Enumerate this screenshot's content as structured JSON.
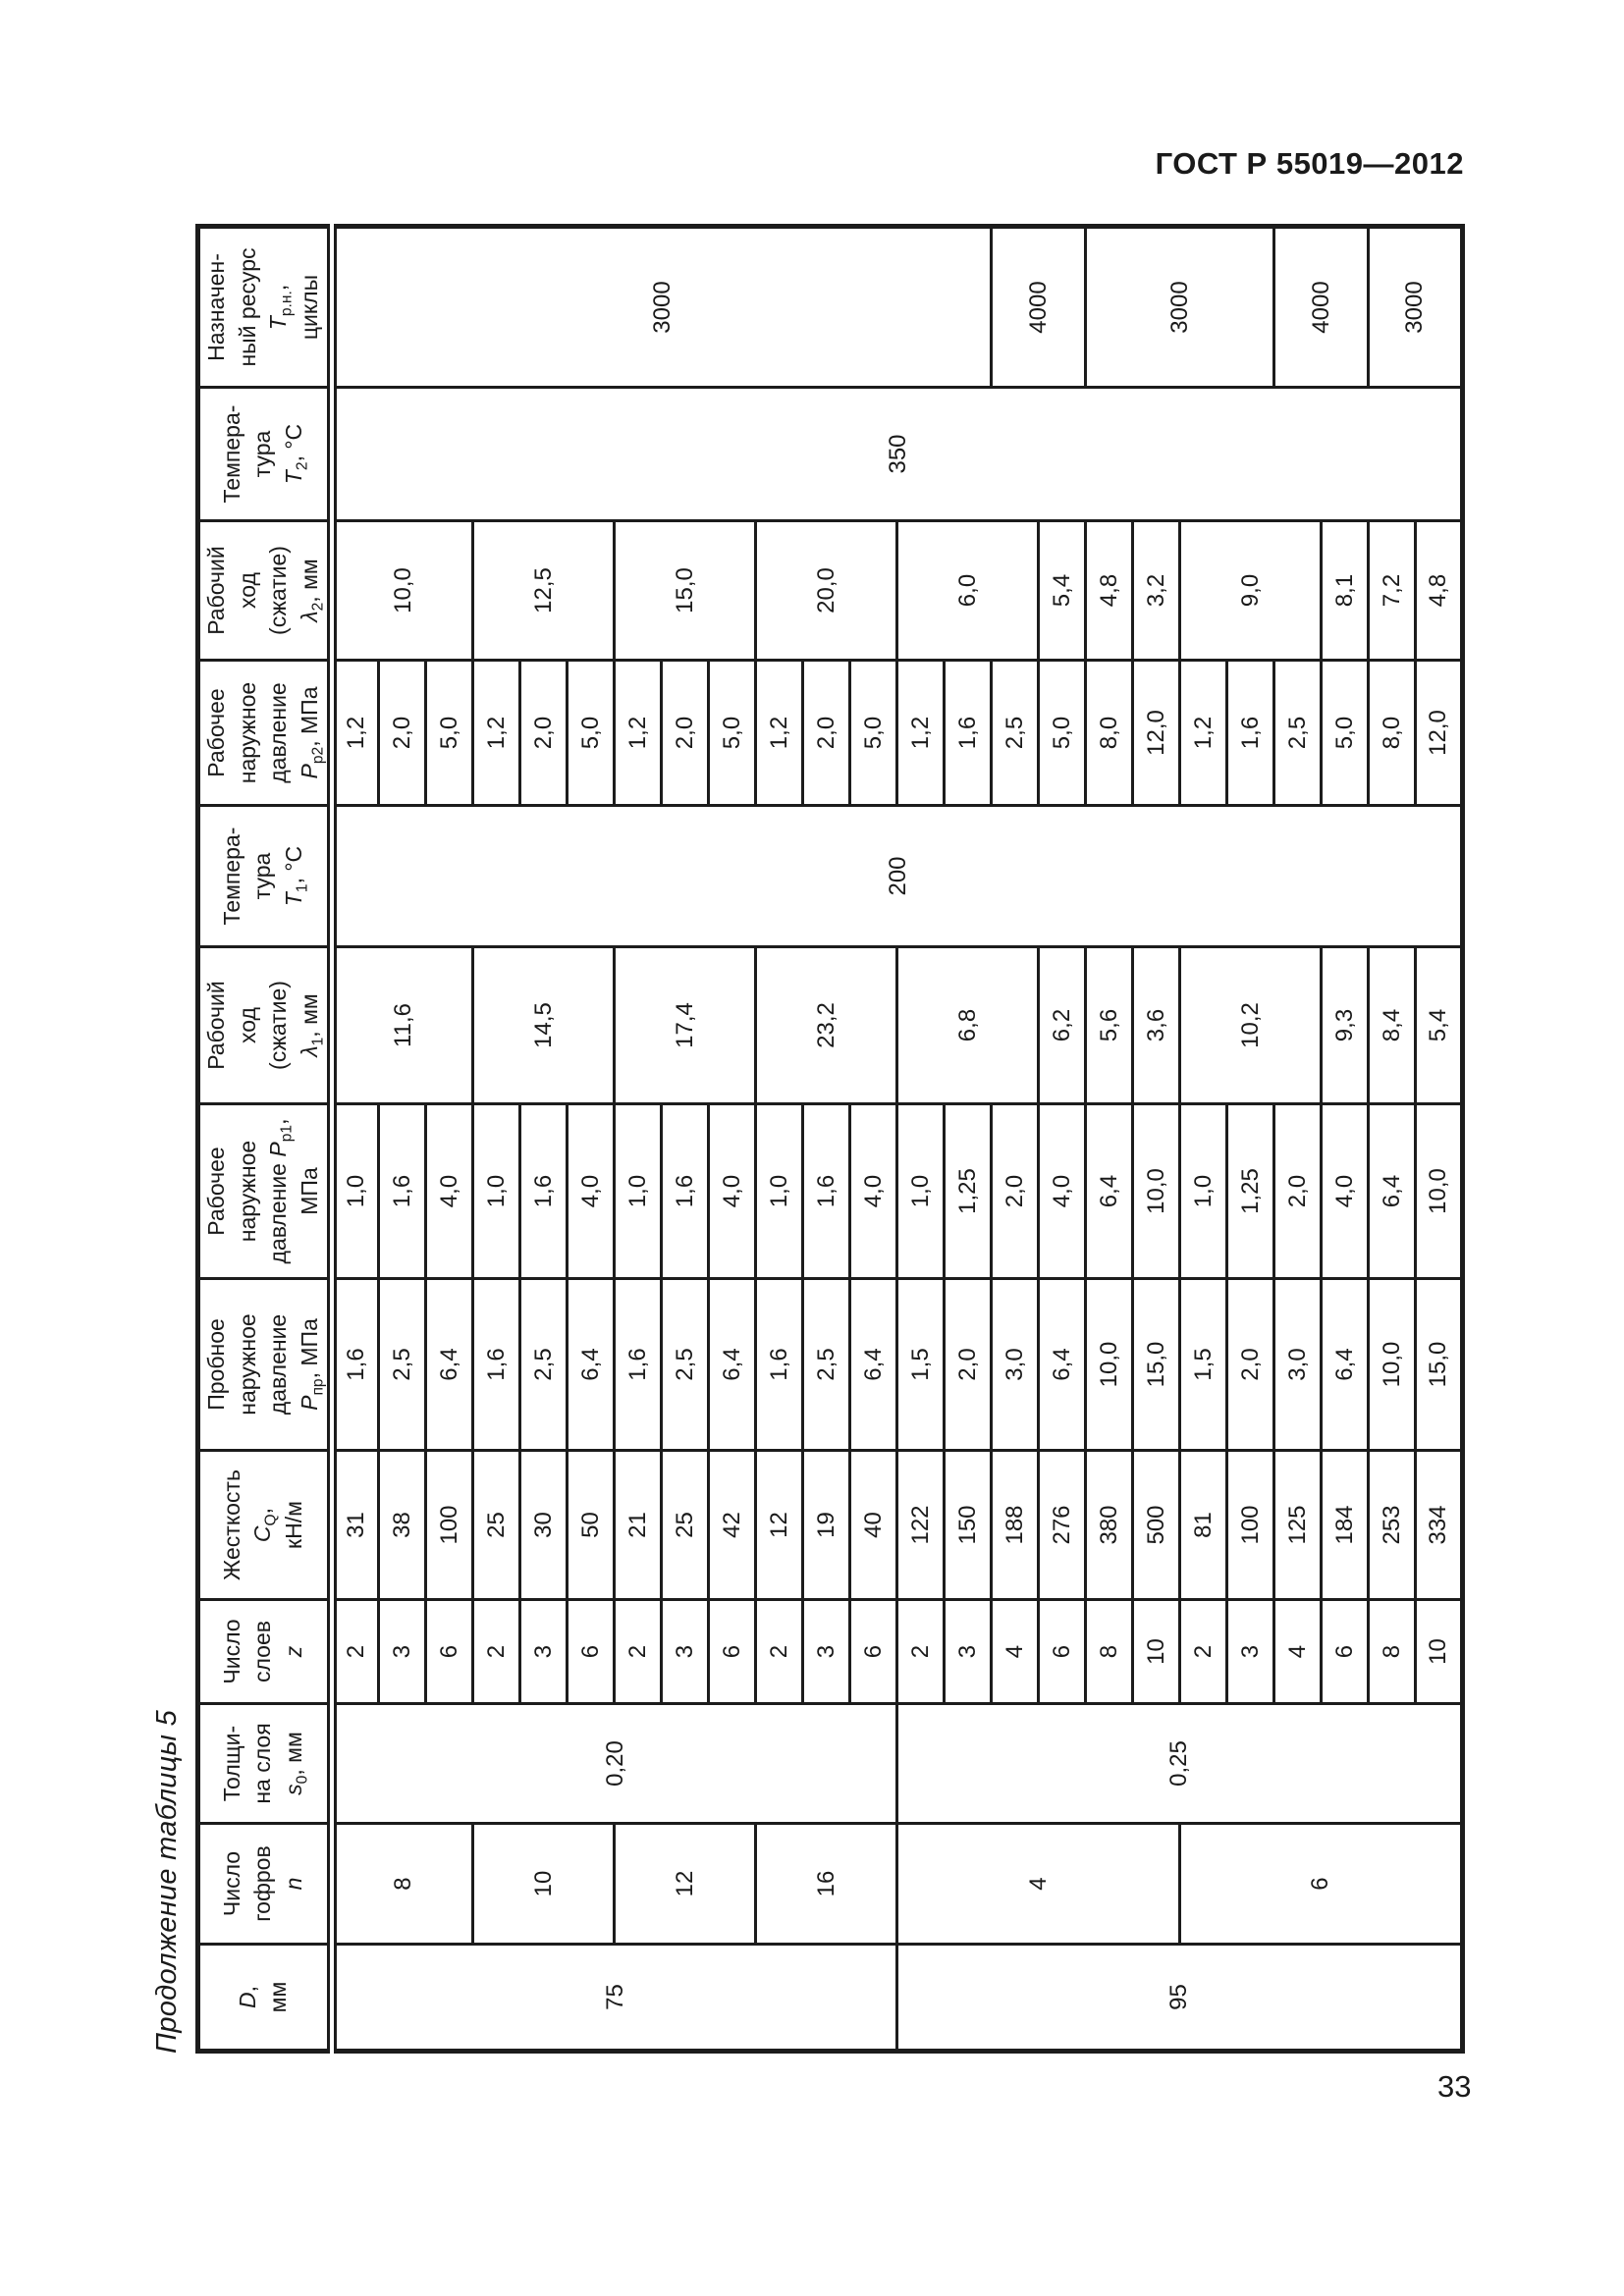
{
  "page": {
    "header_right": "ГОСТ Р 55019—2012",
    "caption": "Продолжение таблицы 5",
    "page_number": "33"
  },
  "table": {
    "row_count": 24,
    "columns": [
      {
        "key": "d",
        "width": 109,
        "label": [
          "*D*,",
          "мм"
        ],
        "cells": [
          {
            "t": "75",
            "s": 12
          },
          {
            "t": "95",
            "s": 12
          }
        ]
      },
      {
        "key": "n",
        "width": 123,
        "label": [
          "Число",
          "гофров",
          "*n*"
        ],
        "cells": [
          {
            "t": "8",
            "s": 3
          },
          {
            "t": "10",
            "s": 3
          },
          {
            "t": "12",
            "s": 3
          },
          {
            "t": "16",
            "s": 3
          },
          {
            "t": "4",
            "s": 6
          },
          {
            "t": "6",
            "s": 6
          }
        ]
      },
      {
        "key": "s0",
        "width": 122,
        "label": [
          "Толщи-",
          "на слоя",
          "*s*~0~, мм"
        ],
        "cells": [
          {
            "t": "0,20",
            "s": 12
          },
          {
            "t": "0,25",
            "s": 12
          }
        ]
      },
      {
        "key": "z",
        "width": 106,
        "label": [
          "Число",
          "слоев",
          "*z*"
        ],
        "cells": [
          "2",
          "3",
          "6",
          "2",
          "3",
          "6",
          "2",
          "3",
          "6",
          "2",
          "3",
          "6",
          "2",
          "3",
          "4",
          "6",
          "8",
          "10",
          "2",
          "3",
          "4",
          "6",
          "8",
          "10"
        ]
      },
      {
        "key": "c",
        "width": 152,
        "label": [
          "Жесткость",
          "*C*~Q~,",
          "кН/м"
        ],
        "cells": [
          "31",
          "38",
          "100",
          "25",
          "30",
          "50",
          "21",
          "25",
          "42",
          "12",
          "19",
          "40",
          "122",
          "150",
          "188",
          "276",
          "380",
          "500",
          "81",
          "100",
          "125",
          "184",
          "253",
          "334"
        ]
      },
      {
        "key": "p_pr",
        "width": 175,
        "label": [
          "Пробное",
          "наружное",
          "давление",
          "*P*~пр~, МПа"
        ],
        "cells": [
          "1,6",
          "2,5",
          "6,4",
          "1,6",
          "2,5",
          "6,4",
          "1,6",
          "2,5",
          "6,4",
          "1,6",
          "2,5",
          "6,4",
          "1,5",
          "2,0",
          "3,0",
          "6,4",
          "10,0",
          "15,0",
          "1,5",
          "2,0",
          "3,0",
          "6,4",
          "10,0",
          "15,0"
        ]
      },
      {
        "key": "p_p1",
        "width": 178,
        "label": [
          "Рабочее",
          "наружное",
          "давление *P*~р1~,",
          "МПа"
        ],
        "cells": [
          "1,0",
          "1,6",
          "4,0",
          "1,0",
          "1,6",
          "4,0",
          "1,0",
          "1,6",
          "4,0",
          "1,0",
          "1,6",
          "4,0",
          "1,0",
          "1,25",
          "2,0",
          "4,0",
          "6,4",
          "10,0",
          "1,0",
          "1,25",
          "2,0",
          "4,0",
          "6,4",
          "10,0"
        ]
      },
      {
        "key": "lambda1",
        "width": 160,
        "label": [
          "Рабочий",
          "ход",
          "(сжатие)",
          "*λ*~1~, мм"
        ],
        "cells": [
          {
            "t": "11,6",
            "s": 3
          },
          {
            "t": "14,5",
            "s": 3
          },
          {
            "t": "17,4",
            "s": 3
          },
          {
            "t": "23,2",
            "s": 3
          },
          {
            "t": "6,8",
            "s": 3
          },
          "6,2",
          "5,6",
          "3,6",
          {
            "t": "10,2",
            "s": 3
          },
          "9,3",
          "8,4",
          "5,4"
        ]
      },
      {
        "key": "t1",
        "width": 144,
        "label": [
          "Темпера-",
          "тура",
          "*T*~1~, °С"
        ],
        "cells": [
          {
            "t": "200",
            "s": 24
          }
        ]
      },
      {
        "key": "p_p2",
        "width": 148,
        "label": [
          "Рабочее",
          "наружное",
          "давление",
          "*P*~р2~, МПа"
        ],
        "cells": [
          "1,2",
          "2,0",
          "5,0",
          "1,2",
          "2,0",
          "5,0",
          "1,2",
          "2,0",
          "5,0",
          "1,2",
          "2,0",
          "5,0",
          "1,2",
          "1,6",
          "2,5",
          "5,0",
          "8,0",
          "12,0",
          "1,2",
          "1,6",
          "2,5",
          "5,0",
          "8,0",
          "12,0"
        ]
      },
      {
        "key": "lambda2",
        "width": 142,
        "label": [
          "Рабочий",
          "ход",
          "(сжатие)",
          "*λ*~2~, мм"
        ],
        "cells": [
          {
            "t": "10,0",
            "s": 3
          },
          {
            "t": "12,5",
            "s": 3
          },
          {
            "t": "15,0",
            "s": 3
          },
          {
            "t": "20,0",
            "s": 3
          },
          {
            "t": "6,0",
            "s": 3
          },
          "5,4",
          "4,8",
          "3,2",
          {
            "t": "9,0",
            "s": 3
          },
          "8,1",
          "7,2",
          "4,8"
        ]
      },
      {
        "key": "t2",
        "width": 136,
        "label": [
          "Темпера-",
          "тура",
          "*T*~2~, °С"
        ],
        "cells": [
          {
            "t": "350",
            "s": 24
          }
        ]
      },
      {
        "key": "resource",
        "width": 164,
        "label": [
          "Назначен-",
          "ный ресурс",
          "*T*~р.н.~,",
          "циклы"
        ],
        "cells": [
          {
            "t": "3000",
            "s": 14
          },
          {
            "t": "4000",
            "s": 2
          },
          {
            "t": "3000",
            "s": 4
          },
          {
            "t": "4000",
            "s": 2
          },
          {
            "t": "3000",
            "s": 2
          }
        ]
      }
    ]
  }
}
